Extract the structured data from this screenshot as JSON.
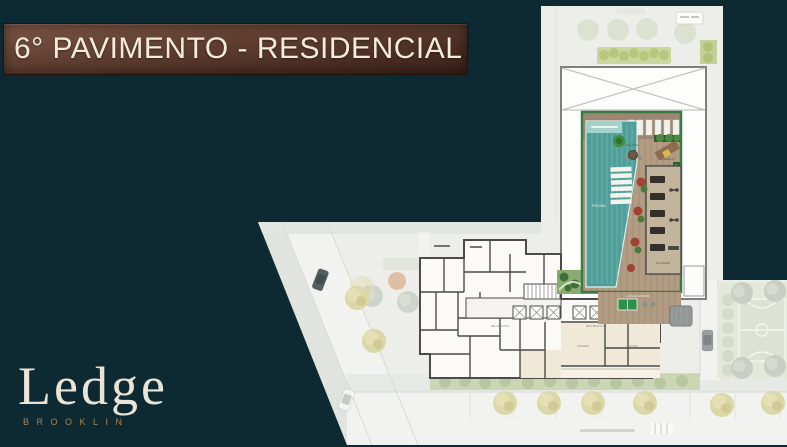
{
  "slide": {
    "title": "6° PAVIMENTO - RESIDENCIAL"
  },
  "logo": {
    "name": "Ledge",
    "subtitle": "BROOKLIN"
  },
  "floor_plan": {
    "labels": {
      "pool": "PISCINA",
      "solarium": "SOLÁRIO",
      "parrilla": "PARRILLA",
      "gym": "ACADEMIA",
      "lounge": "LOUNGE EXTERNO",
      "hall_block_2": "HALL BLOCO 2",
      "hall_block_1": "HALL BLOCO 1",
      "unit_balcony_1": "VARANDA",
      "unit_balcony_2": "VARANDA"
    },
    "colors": {
      "background": "#0d2a33",
      "banner_top": "#7d5746",
      "banner_bottom": "#3a2118",
      "title_text": "#f4ebd8",
      "logo_text": "#e9e5d6",
      "logo_accent": "#a8834f",
      "site_base": "#edeeea",
      "pool_water": "#4f9e99",
      "deck_wood": "#ab967f",
      "green_border": "#3c7a45",
      "walls": "#4b4b4b"
    }
  }
}
